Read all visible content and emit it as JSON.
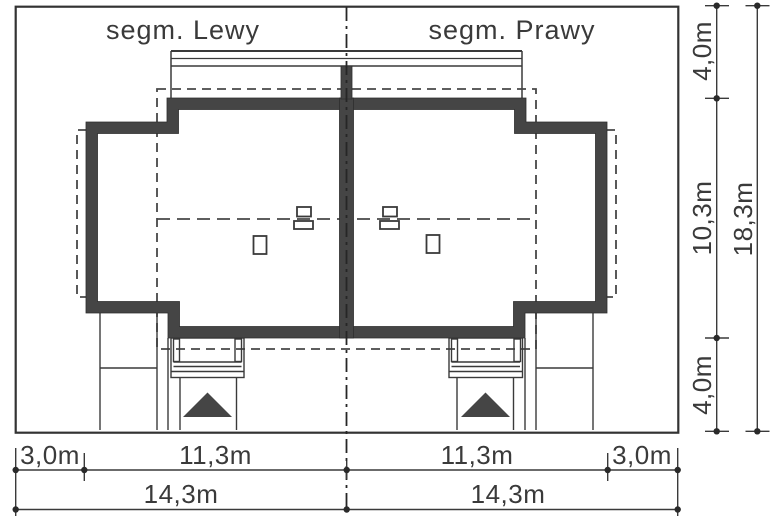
{
  "title": {
    "left_segment": "segm. Lewy",
    "right_segment": "segm. Prawy"
  },
  "dimensions": {
    "bottom_primary": [
      "3,0m",
      "11,3m",
      "11,3m",
      "3,0m"
    ],
    "bottom_total": [
      "14,3m",
      "14,3m"
    ],
    "right_primary": [
      "4,0m",
      "10,3m",
      "4,0m"
    ],
    "right_total": "18,3m"
  },
  "colors": {
    "wall": "#454545",
    "line": "#3a3a3a",
    "background": "#ffffff"
  }
}
